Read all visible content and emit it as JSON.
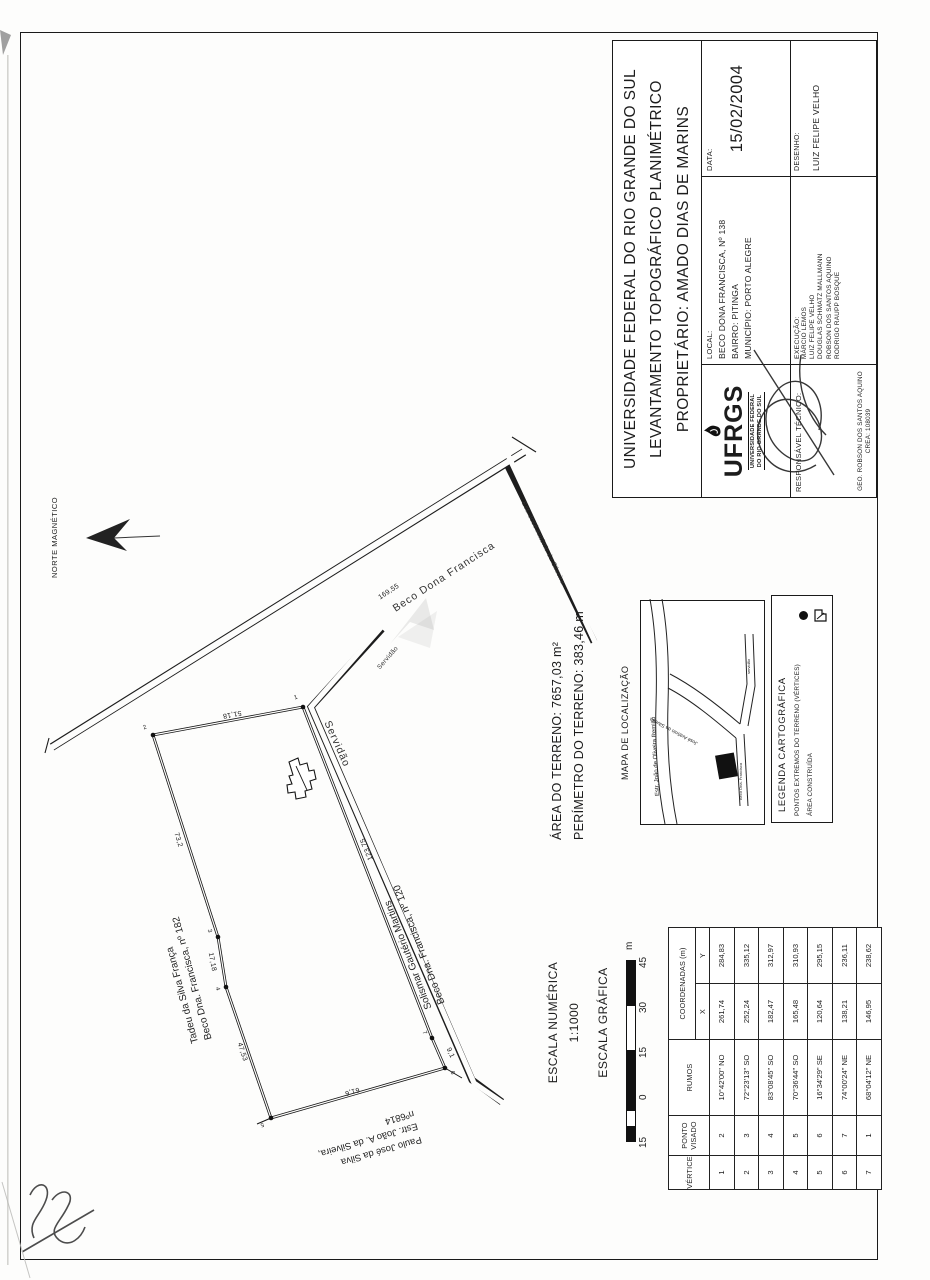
{
  "title_block": {
    "line1": "UNIVERSIDADE FEDERAL DO RIO GRANDE DO SUL",
    "line2": "LEVANTAMENTO TOPOGRÁFICO PLANIMÉTRICO",
    "line3": "PROPRIETÁRIO: AMADO DIAS DE MARINS",
    "local_label": "LOCAL:",
    "local_line1": "BECO DONA FRANCISCA, Nº 138",
    "local_line2": "BAIRRO: PITINGA",
    "local_line3": "MUNICÍPIO: PORTO ALEGRE",
    "data_label": "DATA:",
    "data_value": "15/02/2004",
    "desenho_label": "DESENHO:",
    "desenho_value": "LUIZ FELIPE VELHO",
    "execucao_label": "EXECUÇÃO:",
    "execucao_names": [
      "MÁRCIO LEMOS",
      "LUIZ FELIPE VELHO",
      "DOUGLAS SCHMATZ MALLMANN",
      "ROBSON DOS SANTOS AQUINO",
      "RODRIGO RAUPP BOSQUE"
    ],
    "responsavel_label": "RESPONSÁVEL TÉCNICO:",
    "responsavel_name": "GEO. ROBSON DOS SANTOS AQUINO",
    "responsavel_crea": "CREA: 108039",
    "logo_text": "UFRGS",
    "logo_caption1": "UNIVERSIDADE FEDERAL",
    "logo_caption2": "DO RIO GRANDE DO SUL"
  },
  "north": {
    "label": "NORTE MAGNÉTICO"
  },
  "survey": {
    "area": "ÁREA DO TERRENO: 7657,03 m²",
    "perimeter": "PERÍMETRO DO TERRENO: 383,46 m"
  },
  "map": {
    "title": "MAPA DE LOCALIZAÇÃO",
    "road_top": "Estr. João de Oliveira Remião",
    "road_branch": "José Antônio da Silveira",
    "road_beco": "Beco Dna. Francisca",
    "road_serv": "servidão"
  },
  "legend": {
    "title": "LEGENDA CARTOGRÁFICA",
    "item_vertices": "PONTOS EXTREMOS DO TERRENO (VÉRTICES)",
    "item_area": "ÁREA CONSTRUÍDA"
  },
  "scales": {
    "numeric_label": "ESCALA NUMÉRICA",
    "numeric_value": "1:1000",
    "graphic_label": "ESCALA GRÁFICA",
    "bar_labels": [
      "15",
      "0",
      "15",
      "30",
      "45"
    ],
    "bar_unit": "m"
  },
  "table": {
    "header_vertice": "VÉRTICE",
    "header_ponto1": "PONTO",
    "header_ponto2": "VISADO",
    "header_rumos": "RUMOS",
    "header_coord": "COORDENADAS (m)",
    "header_x": "X",
    "header_y": "Y",
    "rows": [
      {
        "vertice": "1",
        "ponto": "2",
        "rumos": "10°42'00\" NO",
        "x": "261,74",
        "y": "284,83"
      },
      {
        "vertice": "2",
        "ponto": "3",
        "rumos": "72°23'13\" SO",
        "x": "252,24",
        "y": "335,12"
      },
      {
        "vertice": "3",
        "ponto": "4",
        "rumos": "83°08'45\" SO",
        "x": "182,47",
        "y": "312,97"
      },
      {
        "vertice": "4",
        "ponto": "5",
        "rumos": "70°36'44\" SO",
        "x": "165,48",
        "y": "310,93"
      },
      {
        "vertice": "5",
        "ponto": "6",
        "rumos": "16°34'29\" SE",
        "x": "120,64",
        "y": "295,15"
      },
      {
        "vertice": "6",
        "ponto": "7",
        "rumos": "74°00'24\" NE",
        "x": "138,21",
        "y": "236,11"
      },
      {
        "vertice": "7",
        "ponto": "1",
        "rumos": "68°04'12\" NE",
        "x": "146,95",
        "y": "238,62"
      }
    ]
  },
  "drawing": {
    "road_beco": "Beco Dona Francisca",
    "road_servidao_big": "Servidão",
    "road_servidao_small": "Servidão",
    "road_jose": "Est. José Antônio da Silveira",
    "dim_road": "169,55",
    "dim_v1v2": "51,18",
    "dim_v2v3": "73,2",
    "dim_v3v4": "17,18",
    "dim_v4v5": "47,53",
    "dim_v5v6": "61,6",
    "dim_v6v7": "9,1",
    "dim_v7v1": "123,75",
    "vertex_numbers": [
      "1",
      "2",
      "3",
      "4",
      "5",
      "6",
      "7"
    ],
    "neighbor_tadeu_1": "Tadeu da Silva França",
    "neighbor_tadeu_2": "Beco Dna. Francisca, nº 182",
    "neighbor_solismar_1": "Solismar Gautério Martins",
    "neighbor_solismar_2": "Beco Dna. Francisca, nº 120",
    "neighbor_paulo_1": "Paulo José da Silva",
    "neighbor_paulo_2": "Estr. João A. da Silveira,",
    "neighbor_paulo_3": "nº6814"
  },
  "colors": {
    "ink": "#1c1c1c",
    "paper": "#fdfdfc"
  }
}
